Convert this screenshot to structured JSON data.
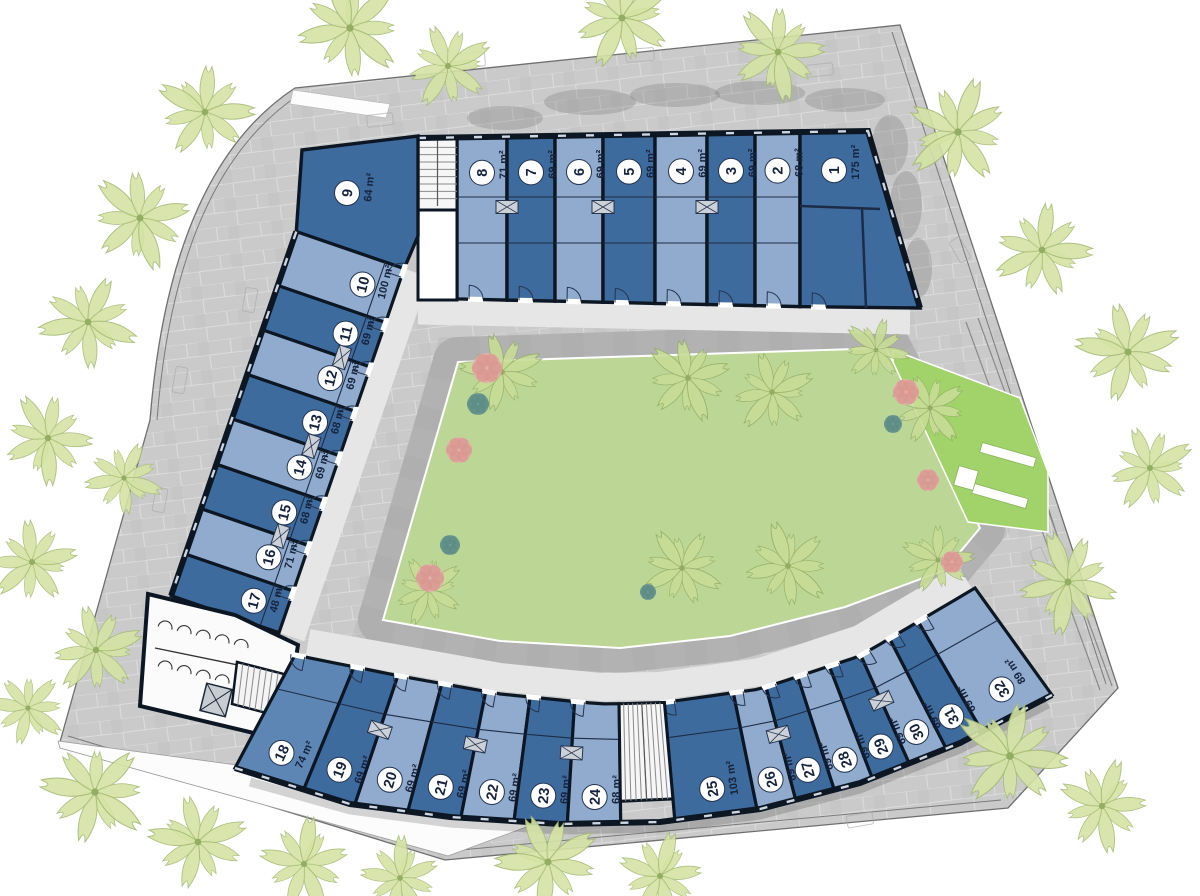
{
  "plan": {
    "area_unit": "m²",
    "units": [
      {
        "no": "1",
        "area": "175 m²"
      },
      {
        "no": "2",
        "area": "68 m²"
      },
      {
        "no": "3",
        "area": "69 m²"
      },
      {
        "no": "4",
        "area": "69 m²"
      },
      {
        "no": "5",
        "area": "69 m²"
      },
      {
        "no": "6",
        "area": "69 m²"
      },
      {
        "no": "7",
        "area": "69 m²"
      },
      {
        "no": "8",
        "area": "71 m²"
      },
      {
        "no": "9",
        "area": "64 m²"
      },
      {
        "no": "10",
        "area": "100 m²"
      },
      {
        "no": "11",
        "area": "69 m²"
      },
      {
        "no": "12",
        "area": "69 m²"
      },
      {
        "no": "13",
        "area": "68 m²"
      },
      {
        "no": "14",
        "area": "69 m²"
      },
      {
        "no": "15",
        "area": "68 m²"
      },
      {
        "no": "16",
        "area": "71 m²"
      },
      {
        "no": "17",
        "area": "48 m²"
      },
      {
        "no": "18",
        "area": "74 m²"
      },
      {
        "no": "19",
        "area": "69 m²"
      },
      {
        "no": "20",
        "area": "69 m²"
      },
      {
        "no": "21",
        "area": "69 m²"
      },
      {
        "no": "22",
        "area": "69 m²"
      },
      {
        "no": "23",
        "area": "69 m²"
      },
      {
        "no": "24",
        "area": "68 m²"
      },
      {
        "no": "25",
        "area": "103 m²"
      },
      {
        "no": "26",
        "area": "69 m²"
      },
      {
        "no": "27",
        "area": "69 m²"
      },
      {
        "no": "28",
        "area": "69 m²"
      },
      {
        "no": "29",
        "area": "69 m²"
      },
      {
        "no": "30",
        "area": "69 m²"
      },
      {
        "no": "31",
        "area": "69 m²"
      },
      {
        "no": "32",
        "area": "89 m²"
      }
    ]
  },
  "palette": {
    "unit_dark": "#3e6b9e",
    "unit_medium": "#5d86b4",
    "unit_light": "#90abce",
    "wall": "#0d1724",
    "grass": "#bcd795",
    "ramp_green": "#a2d36a",
    "paving": "#cacaca",
    "stone_band": "#b2b2b2",
    "walkway": "#e6e6e6",
    "badge_text": "#16233c",
    "frond_outer": "#d5e3a4",
    "frond_court": "#c8dd97",
    "bush_pink": "#e3b0a8",
    "bush_teal": "#6f9b94"
  }
}
